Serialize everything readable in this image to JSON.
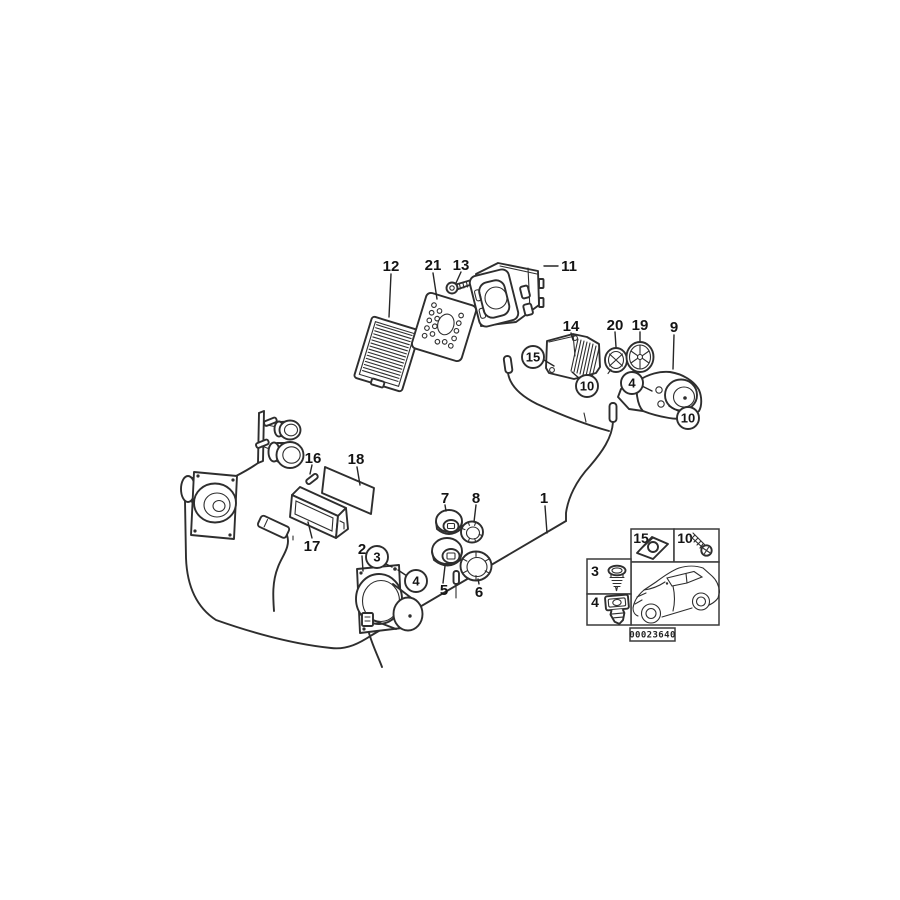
{
  "diagram": {
    "background": "#ffffff",
    "line_color": "#2e2e2e",
    "label_color": "#141414",
    "callouts": [
      {
        "label": "1",
        "circled": false
      },
      {
        "label": "2",
        "circled": false
      },
      {
        "label": "3",
        "circled": true
      },
      {
        "label": "4",
        "circled": true
      },
      {
        "label": "4",
        "circled": true
      },
      {
        "label": "5",
        "circled": false
      },
      {
        "label": "6",
        "circled": false
      },
      {
        "label": "7",
        "circled": false
      },
      {
        "label": "8",
        "circled": false
      },
      {
        "label": "9",
        "circled": false
      },
      {
        "label": "10",
        "circled": true
      },
      {
        "label": "10",
        "circled": true
      },
      {
        "label": "11",
        "circled": false
      },
      {
        "label": "12",
        "circled": false
      },
      {
        "label": "13",
        "circled": false
      },
      {
        "label": "14",
        "circled": false
      },
      {
        "label": "15",
        "circled": true
      },
      {
        "label": "16",
        "circled": false
      },
      {
        "label": "17",
        "circled": false
      },
      {
        "label": "18",
        "circled": false
      },
      {
        "label": "19",
        "circled": false
      },
      {
        "label": "20",
        "circled": false
      },
      {
        "label": "21",
        "circled": false
      }
    ],
    "inset": {
      "cells": [
        {
          "label": "15"
        },
        {
          "label": "10"
        },
        {
          "label": "3"
        },
        {
          "label": "4"
        }
      ],
      "image_id": "00023640"
    }
  }
}
